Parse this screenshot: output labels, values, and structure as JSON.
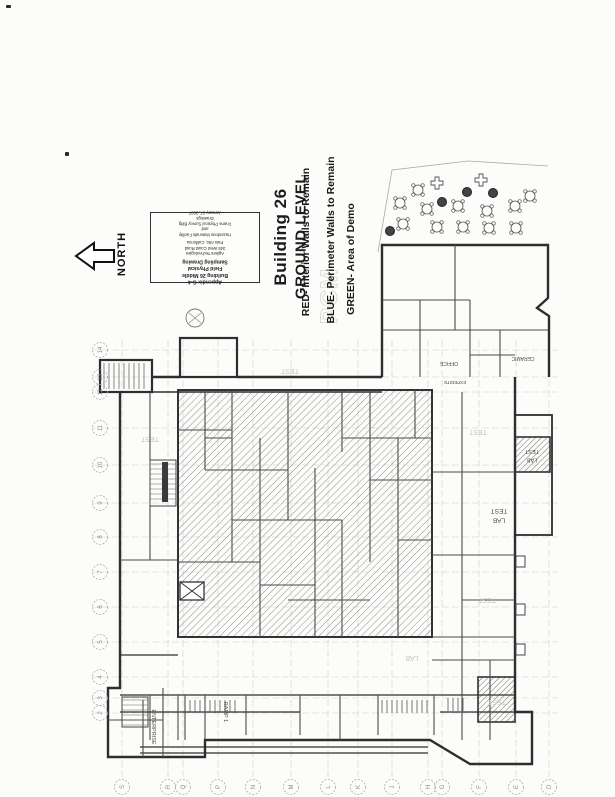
{
  "document": {
    "heading": {
      "line1": "Building 26",
      "line2": "GROUND LEVEL"
    },
    "legend": {
      "red": "RED- Interior Walls to Remain",
      "blue": "BLUE- Perimeter Walls to Remain",
      "green": "GREEN- Area of Demo"
    },
    "north_label": "NORTH",
    "watermark": "PCM",
    "title_block": {
      "bold_lines": [
        "Appendix G-4",
        "Building 26 Middle",
        "Field Physical Sampling Drawing"
      ],
      "small_lines": [
        "Agilent Technologies",
        "345 West Coast Road",
        "Palo Alto, California"
      ],
      "fine_lines": [
        "Hazardous Materials Facility and",
        "Frame Physical Survey Bldg Drawings",
        "January 27, 2007"
      ]
    }
  },
  "plan": {
    "grid": {
      "left_labels": [
        "14",
        "13",
        "12",
        "11",
        "10",
        "9",
        "8",
        "7",
        "6",
        "5",
        "4",
        "3",
        "2"
      ],
      "bottom_labels": [
        "S",
        "R",
        "Q",
        "P",
        "N",
        "M",
        "L",
        "K",
        "J",
        "H",
        "G",
        "F",
        "E",
        "D"
      ]
    },
    "room_labels": [
      "TEST LAB",
      "TEST LAB",
      "CERAMIC",
      "OFFICE",
      "EXPEDITE"
    ],
    "vertical_labels": [
      "ENTERPRISE",
      "RAMP 1"
    ],
    "faint_notes": [
      "TEST",
      "TEST",
      "TEST",
      "TEST",
      "LAB",
      "TEST"
    ],
    "patio": {
      "tables": 12,
      "trees": 4,
      "planters": 2
    }
  },
  "colors": {
    "wall": "#2e2e2e",
    "hatch": "#8f8f8f",
    "grid": "#cccccc",
    "faint": "#c6c6c3",
    "label": "#4a4a4a"
  }
}
